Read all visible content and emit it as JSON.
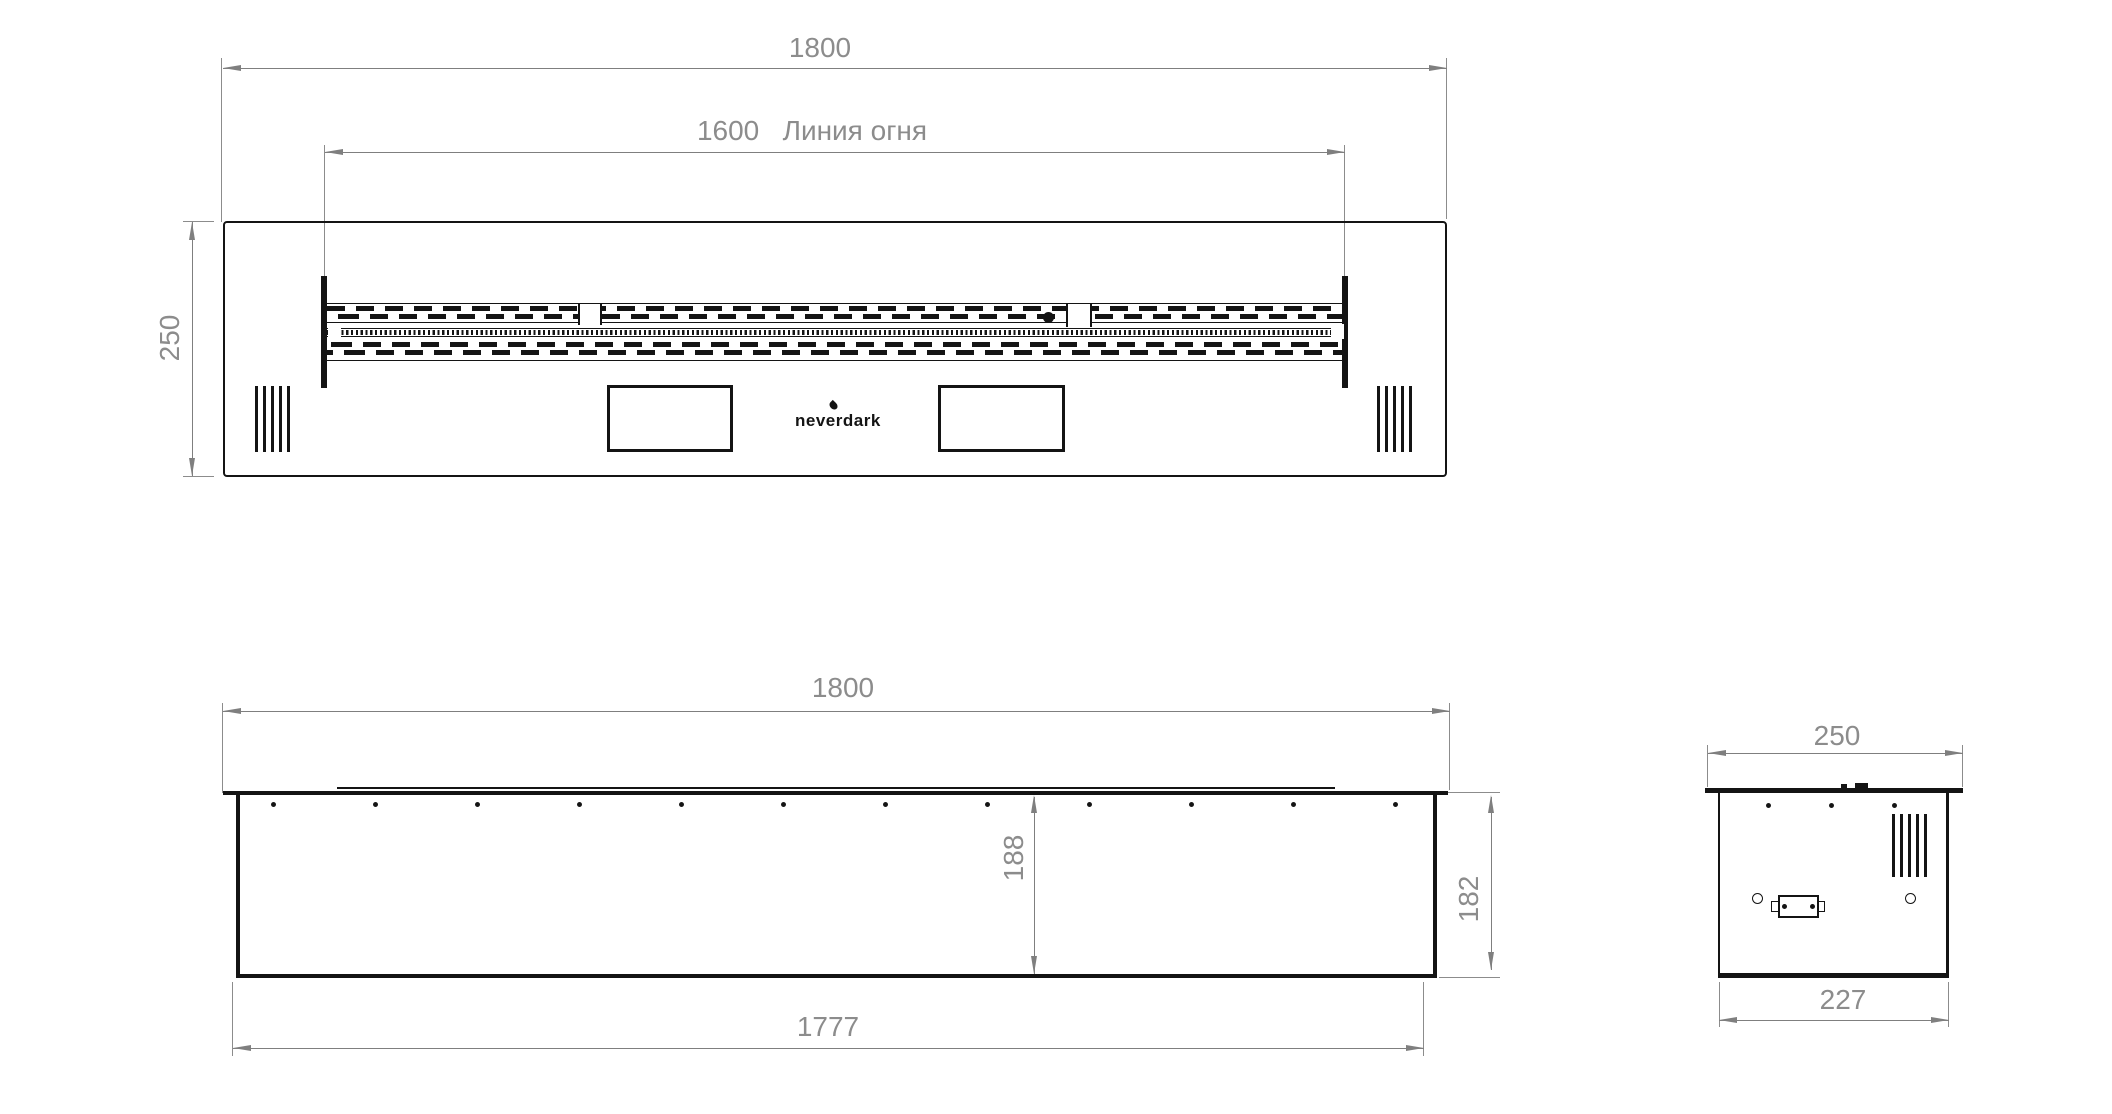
{
  "brand": {
    "logo_text": "neverdark"
  },
  "colors": {
    "object_line": "#141414",
    "dimension_line": "#7f7f7f",
    "dimension_text": "#8c8c8c",
    "background": "#ffffff"
  },
  "top_view": {
    "width_label": "1800",
    "fire_line_label": "1600   Линия огня",
    "depth_label": "250"
  },
  "front_view": {
    "width_label": "1800",
    "inner_height_label": "188",
    "height_label": "182",
    "bottom_width_label": "1777"
  },
  "side_view": {
    "top_width_label": "250",
    "bottom_width_label": "227"
  }
}
